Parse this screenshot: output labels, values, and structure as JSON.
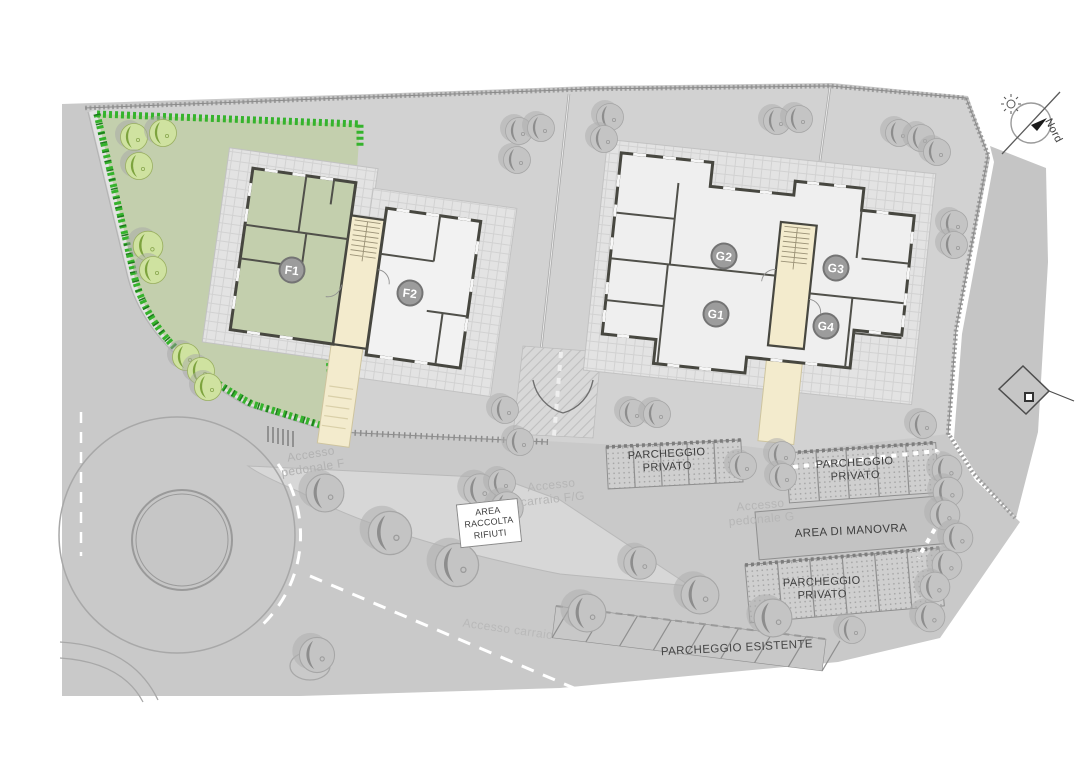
{
  "north": {
    "label": "Nord"
  },
  "units": [
    {
      "id": "F1",
      "label": "F1",
      "x": 292,
      "y": 270
    },
    {
      "id": "F2",
      "label": "F2",
      "x": 410,
      "y": 293
    },
    {
      "id": "G2",
      "label": "G2",
      "x": 724,
      "y": 256
    },
    {
      "id": "G1",
      "label": "G1",
      "x": 716,
      "y": 314
    },
    {
      "id": "G3",
      "label": "G3",
      "x": 836,
      "y": 268
    },
    {
      "id": "G4",
      "label": "G4",
      "x": 826,
      "y": 326
    }
  ],
  "map": {
    "labels": [
      {
        "id": "parcheggio-privato-1",
        "text": "PARCHEGGIO PRIVATO",
        "x": 667,
        "y": 461,
        "rot": -3,
        "size": 11,
        "w": 118,
        "color": "#3d3d3d"
      },
      {
        "id": "parcheggio-privato-2",
        "text": "PARCHEGGIO PRIVATO",
        "x": 855,
        "y": 470,
        "rot": -3,
        "size": 11,
        "w": 118,
        "color": "#3d3d3d"
      },
      {
        "id": "area-di-manovra",
        "text": "AREA DI MANOVRA",
        "x": 851,
        "y": 532,
        "rot": -3,
        "size": 11.5,
        "w": 190,
        "color": "#3d3d3d"
      },
      {
        "id": "parcheggio-privato-3",
        "text": "PARCHEGGIO PRIVATO",
        "x": 822,
        "y": 589,
        "rot": -2,
        "size": 11,
        "w": 118,
        "color": "#3d3d3d"
      },
      {
        "id": "parcheggio-esistente",
        "text": "PARCHEGGIO ESISTENTE",
        "x": 737,
        "y": 649,
        "rot": -3,
        "size": 11.5,
        "w": 240,
        "color": "#454545"
      },
      {
        "id": "area-raccolta-rifiuti",
        "text": "AREA RACCOLTA RIFIUTI",
        "x": 489,
        "y": 523,
        "rot": -6,
        "size": 9,
        "w": 56,
        "color": "#3d3d3d",
        "box": true
      },
      {
        "id": "accesso-pedonale-f",
        "text": "Accesso pedonale F",
        "x": 312,
        "y": 461,
        "rot": -9,
        "size": 12,
        "w": 82,
        "color": "#b2b2b2"
      },
      {
        "id": "accesso-carraio-fg",
        "text": "Accesso carraio F/G",
        "x": 552,
        "y": 492,
        "rot": -6,
        "size": 12,
        "w": 82,
        "color": "#b6b6b6"
      },
      {
        "id": "accesso-pedonale-g",
        "text": "Accesso pedonale G",
        "x": 761,
        "y": 512,
        "rot": -5,
        "size": 12,
        "w": 86,
        "color": "#b6b6b6"
      },
      {
        "id": "accesso-carraio-esistente",
        "text": "Accesso carraio",
        "x": 508,
        "y": 629,
        "rot": 8,
        "size": 12,
        "w": 130,
        "color": "#b9b9b9"
      }
    ],
    "parking_lots": [
      {
        "id": "privato-fg",
        "label": "PARCHEGGIO PRIVATO",
        "x": 606,
        "y": 447,
        "w": 135,
        "h": 42,
        "rot": -3,
        "stalls": 5,
        "style": "hatched"
      },
      {
        "id": "privato-g-est",
        "label": "PARCHEGGIO PRIVATO",
        "x": 786,
        "y": 453,
        "w": 150,
        "h": 50,
        "rot": -4,
        "stalls": 5,
        "style": "hatched"
      },
      {
        "id": "manovra",
        "label": "AREA DI MANOVRA",
        "x": 755,
        "y": 512,
        "w": 200,
        "h": 48,
        "rot": -5,
        "stalls": 0,
        "style": "plain"
      },
      {
        "id": "privato-sud",
        "label": "PARCHEGGIO PRIVATO",
        "x": 745,
        "y": 565,
        "w": 195,
        "h": 58,
        "rot": -5,
        "stalls": 6,
        "style": "hatched"
      },
      {
        "id": "esistente",
        "label": "PARCHEGGIO ESISTENTE",
        "x": 556,
        "y": 606,
        "w": 272,
        "h": 32,
        "rot": 7,
        "stalls": 8,
        "style": "open",
        "slant": true
      }
    ],
    "trees": [
      {
        "x": 134,
        "y": 137,
        "k": "green"
      },
      {
        "x": 163,
        "y": 133,
        "k": "green"
      },
      {
        "x": 139,
        "y": 166,
        "k": "green"
      },
      {
        "x": 148,
        "y": 246,
        "k": "green",
        "s": 1.1
      },
      {
        "x": 153,
        "y": 270,
        "k": "green"
      },
      {
        "x": 186,
        "y": 357,
        "k": "green"
      },
      {
        "x": 201,
        "y": 371,
        "k": "green"
      },
      {
        "x": 208,
        "y": 387,
        "k": "green"
      },
      {
        "x": 519,
        "y": 131,
        "k": "gray"
      },
      {
        "x": 541,
        "y": 128,
        "k": "gray"
      },
      {
        "x": 517,
        "y": 160,
        "k": "gray"
      },
      {
        "x": 610,
        "y": 117,
        "k": "gray"
      },
      {
        "x": 604,
        "y": 139,
        "k": "gray"
      },
      {
        "x": 777,
        "y": 121,
        "k": "gray"
      },
      {
        "x": 799,
        "y": 119,
        "k": "gray"
      },
      {
        "x": 899,
        "y": 133,
        "k": "gray"
      },
      {
        "x": 921,
        "y": 138,
        "k": "gray"
      },
      {
        "x": 937,
        "y": 152,
        "k": "gray"
      },
      {
        "x": 954,
        "y": 224,
        "k": "gray"
      },
      {
        "x": 954,
        "y": 245,
        "k": "gray"
      },
      {
        "x": 505,
        "y": 410,
        "k": "gray"
      },
      {
        "x": 520,
        "y": 442,
        "k": "gray"
      },
      {
        "x": 633,
        "y": 413,
        "k": "gray"
      },
      {
        "x": 657,
        "y": 414,
        "k": "gray"
      },
      {
        "x": 743,
        "y": 466,
        "k": "gray"
      },
      {
        "x": 782,
        "y": 455,
        "k": "gray"
      },
      {
        "x": 783,
        "y": 477,
        "k": "gray"
      },
      {
        "x": 923,
        "y": 425,
        "k": "gray"
      },
      {
        "x": 947,
        "y": 470,
        "k": "gray",
        "s": 1.1
      },
      {
        "x": 948,
        "y": 492,
        "k": "gray",
        "s": 1.1
      },
      {
        "x": 945,
        "y": 515,
        "k": "gray",
        "s": 1.1
      },
      {
        "x": 958,
        "y": 538,
        "k": "gray",
        "s": 1.1
      },
      {
        "x": 947,
        "y": 565,
        "k": "gray",
        "s": 1.1
      },
      {
        "x": 935,
        "y": 587,
        "k": "gray",
        "s": 1.1
      },
      {
        "x": 930,
        "y": 617,
        "k": "gray",
        "s": 1.1
      },
      {
        "x": 852,
        "y": 630,
        "k": "gray"
      },
      {
        "x": 325,
        "y": 493,
        "k": "gray",
        "s": 1.4
      },
      {
        "x": 390,
        "y": 533,
        "k": "gray",
        "s": 1.6
      },
      {
        "x": 457,
        "y": 565,
        "k": "gray",
        "s": 1.6
      },
      {
        "x": 480,
        "y": 490,
        "k": "gray",
        "s": 1.2
      },
      {
        "x": 502,
        "y": 483,
        "k": "gray"
      },
      {
        "x": 507,
        "y": 508,
        "k": "gray",
        "s": 1.2
      },
      {
        "x": 587,
        "y": 613,
        "k": "gray",
        "s": 1.4
      },
      {
        "x": 640,
        "y": 563,
        "k": "gray",
        "s": 1.2
      },
      {
        "x": 700,
        "y": 595,
        "k": "gray",
        "s": 1.4
      },
      {
        "x": 773,
        "y": 618,
        "k": "gray",
        "s": 1.4
      },
      {
        "x": 317,
        "y": 655,
        "k": "gray",
        "s": 1.3
      }
    ]
  }
}
